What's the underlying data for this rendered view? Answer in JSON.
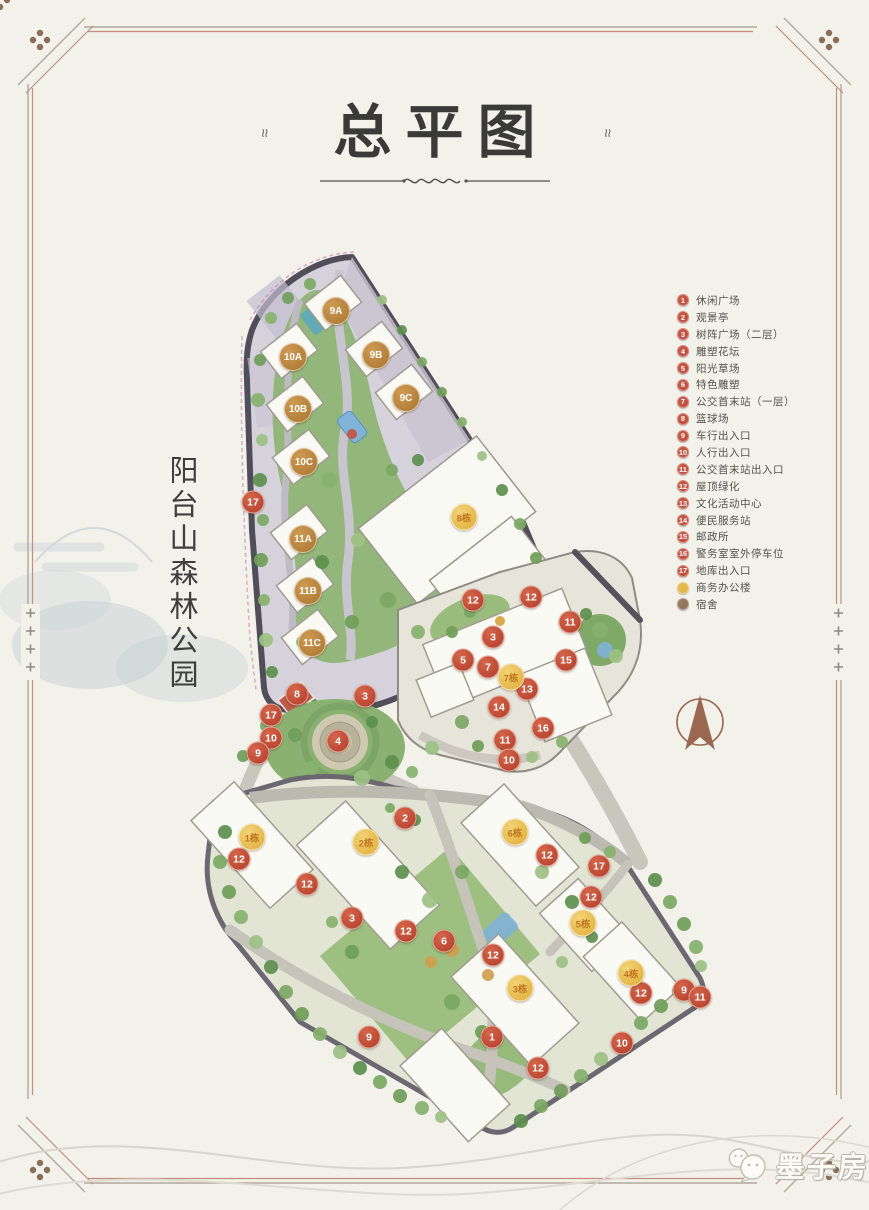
{
  "header": {
    "title": "总平图",
    "ornament": "≈"
  },
  "map": {
    "side_label": "阳台山森林公园",
    "colors": {
      "marker_red": "#bf4331",
      "building_gold": "#e0ac38",
      "building_bronze": "#a9742f",
      "legend_office": "#e3b23c",
      "legend_dorm": "#8a6a52"
    },
    "icons": {
      "compass": "north-arrow",
      "watermark_icon": "wechat-bubbles"
    },
    "building_badges": [
      {
        "label": "9A",
        "x": 336,
        "y": 311,
        "style": "bronze"
      },
      {
        "label": "9B",
        "x": 376,
        "y": 355,
        "style": "bronze"
      },
      {
        "label": "9C",
        "x": 406,
        "y": 398,
        "style": "bronze"
      },
      {
        "label": "10A",
        "x": 293,
        "y": 357,
        "style": "bronze"
      },
      {
        "label": "10B",
        "x": 298,
        "y": 409,
        "style": "bronze"
      },
      {
        "label": "10C",
        "x": 304,
        "y": 462,
        "style": "bronze"
      },
      {
        "label": "11A",
        "x": 303,
        "y": 539,
        "style": "bronze"
      },
      {
        "label": "11B",
        "x": 308,
        "y": 591,
        "style": "bronze"
      },
      {
        "label": "11C",
        "x": 312,
        "y": 643,
        "style": "bronze"
      },
      {
        "label": "8栋",
        "x": 464,
        "y": 517,
        "style": "gold"
      },
      {
        "label": "7栋",
        "x": 511,
        "y": 677,
        "style": "gold"
      },
      {
        "label": "1栋",
        "x": 252,
        "y": 837,
        "style": "gold"
      },
      {
        "label": "2栋",
        "x": 366,
        "y": 842,
        "style": "gold"
      },
      {
        "label": "6栋",
        "x": 515,
        "y": 832,
        "style": "gold"
      },
      {
        "label": "5栋",
        "x": 583,
        "y": 923,
        "style": "gold"
      },
      {
        "label": "3栋",
        "x": 520,
        "y": 988,
        "style": "gold"
      },
      {
        "label": "4栋",
        "x": 631,
        "y": 973,
        "style": "gold"
      }
    ],
    "marker_badges": [
      {
        "num": "17",
        "x": 253,
        "y": 502
      },
      {
        "num": "8",
        "x": 297,
        "y": 694
      },
      {
        "num": "3",
        "x": 365,
        "y": 696
      },
      {
        "num": "17",
        "x": 271,
        "y": 715
      },
      {
        "num": "10",
        "x": 271,
        "y": 738
      },
      {
        "num": "9",
        "x": 258,
        "y": 753
      },
      {
        "num": "4",
        "x": 338,
        "y": 741
      },
      {
        "num": "12",
        "x": 473,
        "y": 600
      },
      {
        "num": "12",
        "x": 531,
        "y": 597
      },
      {
        "num": "11",
        "x": 570,
        "y": 622
      },
      {
        "num": "3",
        "x": 493,
        "y": 637
      },
      {
        "num": "5",
        "x": 463,
        "y": 660
      },
      {
        "num": "7",
        "x": 488,
        "y": 667
      },
      {
        "num": "15",
        "x": 566,
        "y": 660
      },
      {
        "num": "13",
        "x": 527,
        "y": 689
      },
      {
        "num": "14",
        "x": 499,
        "y": 707
      },
      {
        "num": "16",
        "x": 543,
        "y": 728
      },
      {
        "num": "11",
        "x": 505,
        "y": 740
      },
      {
        "num": "10",
        "x": 509,
        "y": 760
      },
      {
        "num": "2",
        "x": 405,
        "y": 818
      },
      {
        "num": "12",
        "x": 239,
        "y": 859
      },
      {
        "num": "12",
        "x": 307,
        "y": 884
      },
      {
        "num": "3",
        "x": 352,
        "y": 918
      },
      {
        "num": "12",
        "x": 406,
        "y": 931
      },
      {
        "num": "6",
        "x": 444,
        "y": 941
      },
      {
        "num": "12",
        "x": 493,
        "y": 955
      },
      {
        "num": "12",
        "x": 547,
        "y": 855
      },
      {
        "num": "17",
        "x": 599,
        "y": 866
      },
      {
        "num": "12",
        "x": 591,
        "y": 897
      },
      {
        "num": "12",
        "x": 641,
        "y": 993
      },
      {
        "num": "9",
        "x": 684,
        "y": 990
      },
      {
        "num": "11",
        "x": 700,
        "y": 997
      },
      {
        "num": "10",
        "x": 622,
        "y": 1043
      },
      {
        "num": "12",
        "x": 538,
        "y": 1068
      },
      {
        "num": "9",
        "x": 369,
        "y": 1037
      },
      {
        "num": "1",
        "x": 492,
        "y": 1037
      }
    ]
  },
  "legend": {
    "items": [
      {
        "num": "1",
        "label": "休闲广场",
        "color": "#bf4331"
      },
      {
        "num": "2",
        "label": "观景亭",
        "color": "#bf4331"
      },
      {
        "num": "3",
        "label": "树阵广场（二层）",
        "color": "#bf4331"
      },
      {
        "num": "4",
        "label": "雕塑花坛",
        "color": "#bf4331"
      },
      {
        "num": "5",
        "label": "阳光草场",
        "color": "#bf4331"
      },
      {
        "num": "6",
        "label": "特色雕塑",
        "color": "#bf4331"
      },
      {
        "num": "7",
        "label": "公交首末站（一层）",
        "color": "#bf4331"
      },
      {
        "num": "8",
        "label": "篮球场",
        "color": "#bf4331"
      },
      {
        "num": "9",
        "label": "车行出入口",
        "color": "#bf4331"
      },
      {
        "num": "10",
        "label": "人行出入口",
        "color": "#bf4331"
      },
      {
        "num": "11",
        "label": "公交首末站出入口",
        "color": "#bf4331"
      },
      {
        "num": "12",
        "label": "屋顶绿化",
        "color": "#bf4331"
      },
      {
        "num": "13",
        "label": "文化活动中心",
        "color": "#bf4331"
      },
      {
        "num": "14",
        "label": "便民服务站",
        "color": "#bf4331"
      },
      {
        "num": "15",
        "label": "邮政所",
        "color": "#bf4331"
      },
      {
        "num": "16",
        "label": "警务室室外停车位",
        "color": "#bf4331"
      },
      {
        "num": "17",
        "label": "地库出入口",
        "color": "#bf4331"
      },
      {
        "num": "",
        "label": "商务办公楼",
        "color": "#e3b23c"
      },
      {
        "num": "",
        "label": "宿舍",
        "color": "#8a6a52"
      }
    ]
  },
  "watermark": {
    "text": "墨子房"
  }
}
